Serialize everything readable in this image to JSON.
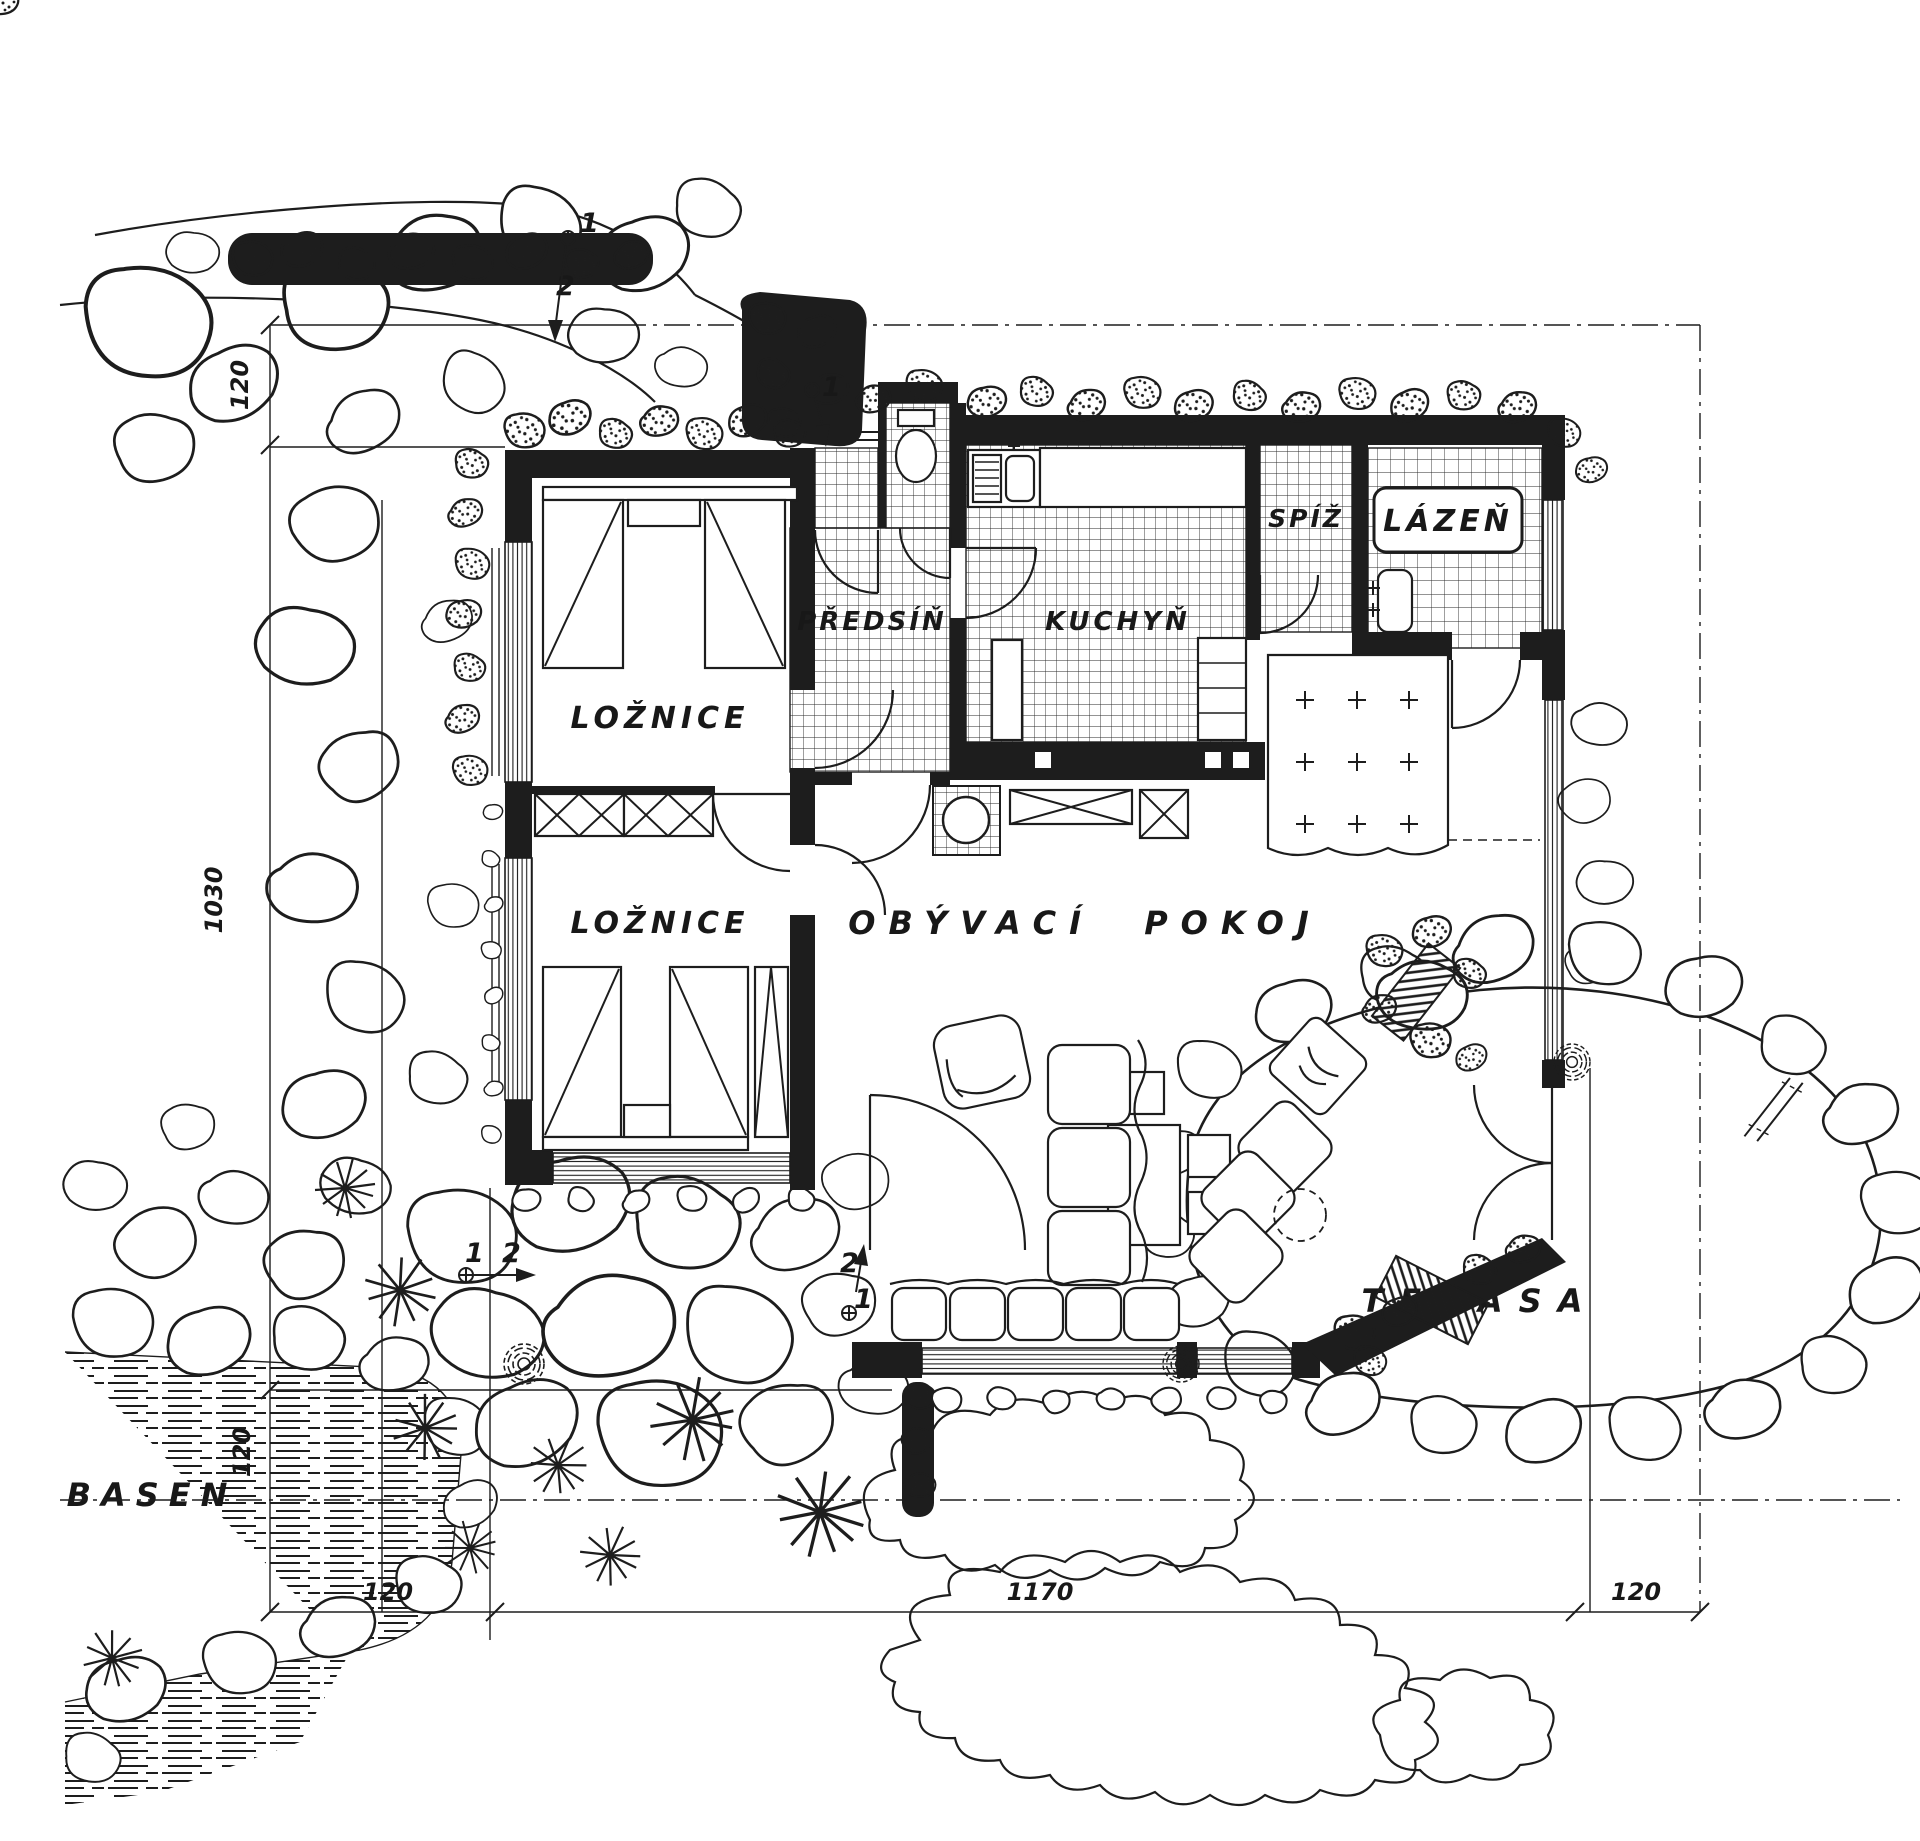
{
  "meta": {
    "drawing_type": "house floor plan with site",
    "paper_color": "#ffffff",
    "ink_color": "#1d1d1d"
  },
  "rooms": {
    "bedroom1": "LOŽNICE",
    "bedroom2": "LOŽNICE",
    "hall": "PŘEDSÍŇ",
    "kitchen": "KUCHYŇ",
    "pantry": "SPÍŽ",
    "bath": "LÁZEŇ",
    "living": "OBÝVACÍ POKOJ",
    "terrace": "TERASA",
    "pool": "BASEN"
  },
  "dimensions": {
    "left_top": "120",
    "left_middle": "1030",
    "left_bottom": "120",
    "bottom_left": "120",
    "bottom_middle": "1170",
    "bottom_right": "120"
  },
  "section_marks": {
    "one": "1",
    "two": "2"
  }
}
